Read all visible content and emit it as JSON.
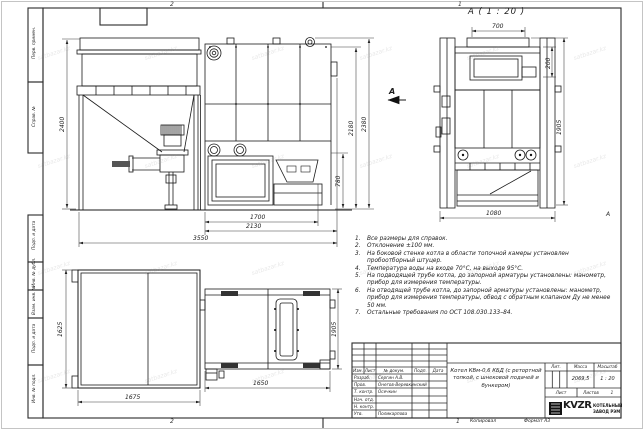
{
  "watermark": "satbazar.kz",
  "sheet": {
    "zone_top_left": "2",
    "zone_top_right": "1",
    "zone_bottom_left": "2",
    "zone_bottom_right": "1",
    "zone_right_letter": "А",
    "copied_label": "Копировал",
    "format_label": "Формат А3"
  },
  "side_stamp": {
    "perv_primen": "Перв. примен.",
    "sprav_no": "Справ. №",
    "podp_data1": "Подп. и дата",
    "inv_dubl": "Инв. № дубл.",
    "vzam_inv": "Взам. инв. №",
    "podp_data2": "Подп. и дата",
    "inv_podl": "Инв. № подл."
  },
  "front_view": {
    "dim_height": "2400",
    "dim_total_width": "3550",
    "dim_width_2130": "2130",
    "dim_width_1700": "1700",
    "dim_furnace_h": "780",
    "dim_body_h": "2180",
    "dim_full_h": "2380"
  },
  "section_view": {
    "label": "А ( 1 : 20 )",
    "arrow_label": "А",
    "dim_top": "700",
    "dim_opening": "200",
    "dim_height": "1905",
    "dim_base": "1080"
  },
  "plan_view": {
    "dim_bunker_h": "1625",
    "dim_bunker_w": "1675",
    "dim_boiler_w": "1650",
    "dim_boiler_d": "1905"
  },
  "notes": {
    "items": [
      {
        "num": "1.",
        "text": "Все размеры для справок."
      },
      {
        "num": "2.",
        "text": "Отклонение ±100 мм."
      },
      {
        "num": "3.",
        "text": "На боковой стенке котла в области топочной камеры установлен пробоотборный штуцер."
      },
      {
        "num": "4.",
        "text": "Температура воды на входе 70°С, на выходе 95°С."
      },
      {
        "num": "5.",
        "text": "На подводящей трубе котла, до запорной арматуры установлены: манометр, прибор для измерения температуры."
      },
      {
        "num": "6.",
        "text": "На отводящей трубе котла, до запорной арматуры установлены: манометр, прибор для измерения температуры, обвод с обратным клапаном Ду не менее 50 мм."
      },
      {
        "num": "7.",
        "text": "Остальные требования по ОСТ 108.030.133–84."
      }
    ]
  },
  "title_block": {
    "col_izm": "Изм.",
    "col_list": "Лист",
    "col_doc": "№ докум.",
    "col_podp": "Подп.",
    "col_data": "Дата",
    "rows": [
      {
        "role": "Разраб.",
        "name": "Сергин А.В."
      },
      {
        "role": "Пров.",
        "name": "Онегов-Веревкинский"
      },
      {
        "role": "Т. контр.",
        "name": "Осечкин"
      },
      {
        "role": "Нач. отд.",
        "name": ""
      },
      {
        "role": "Н. контр.",
        "name": ""
      },
      {
        "role": "Утв.",
        "name": "Поликарпова"
      }
    ],
    "doc_title": "Котел КВм-0,6 КБД (с ретортной топкой, с шнековой подачей и бункером)",
    "lit_label": "Лит.",
    "mass_label": "Масса",
    "scale_label": "Масштаб",
    "mass_value": "2069,5",
    "scale_value": "1 : 20",
    "list_label": "Лист",
    "listov_label": "Листов",
    "listov_value": "1",
    "logo_text": "KVZR",
    "company_line1": "КОТЕЛЬНЫЙ",
    "company_line2": "ЗАВОД РЭМ"
  }
}
